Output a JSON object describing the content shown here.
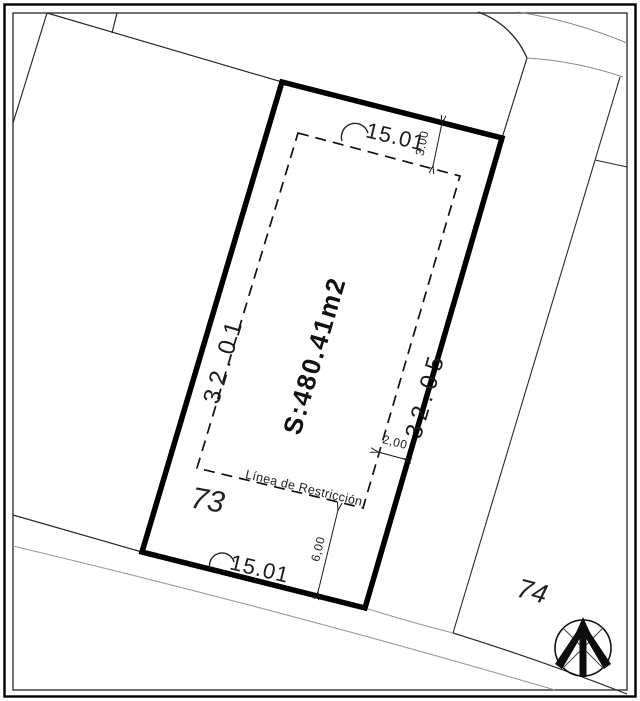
{
  "drawing": {
    "title": "cadastral-lot-plan",
    "area_label": "S:480.41m2",
    "dimensions": {
      "left_side": "32.01",
      "right_side": "32.05",
      "top_side": "15.01",
      "bottom_side": "15.01",
      "top_setback": "3.00",
      "side_setback": "2,00",
      "rear_setback": "6,00"
    },
    "restriction_line_label": "Línea de Restricción",
    "lot_numbers": {
      "subject_lot": "73",
      "neighbor_lot": "74"
    },
    "colors": {
      "line": "#000000",
      "thin_line": "#2a2a2a",
      "light_line": "#8a8a8a",
      "background": "#ffffff"
    }
  }
}
